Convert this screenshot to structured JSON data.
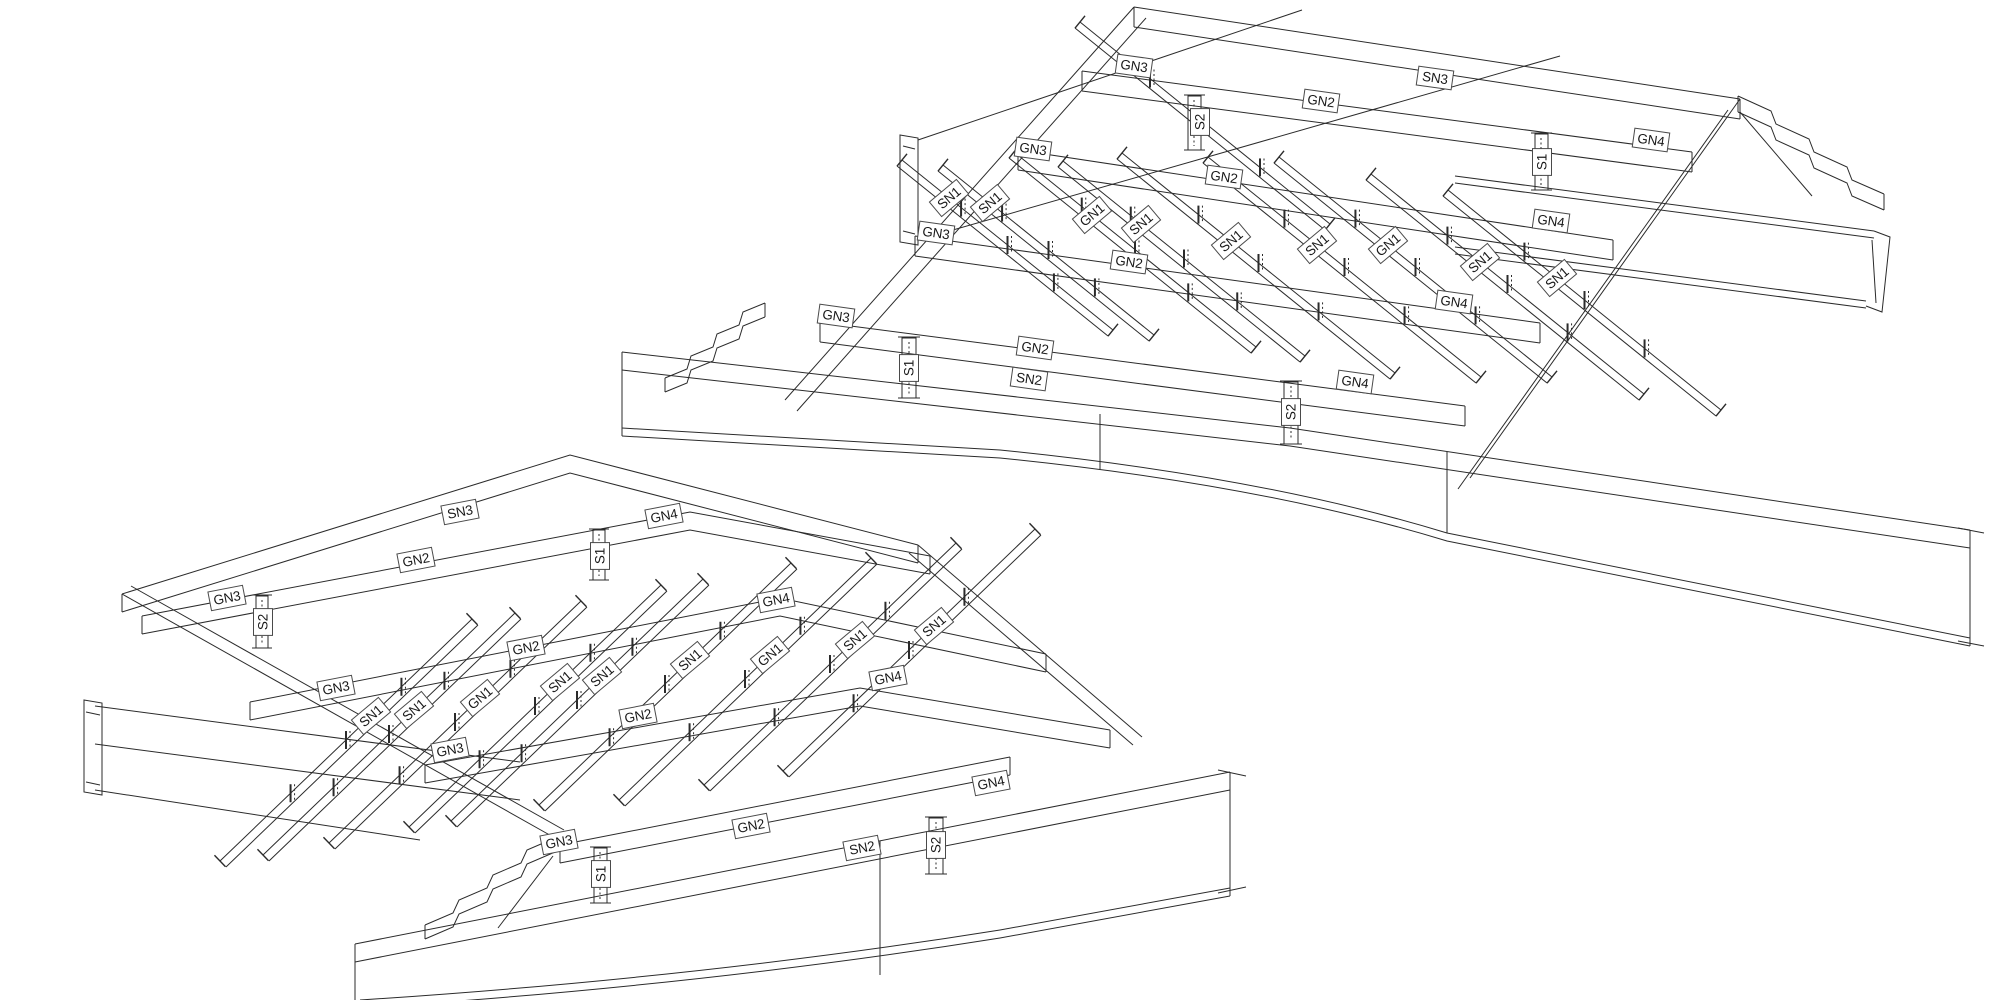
{
  "drawing": {
    "background_color": "#ffffff",
    "line_color": "#2b2b2b",
    "label_box_fill": "#ffffff",
    "label_box_border": "#4a4a4a",
    "label_text_color": "#1a1a1a",
    "structures": [
      {
        "id": "upper-grillage",
        "h_label_angle": 8,
        "diamond_label_angle": -40,
        "vertical_label_angle": -90,
        "labels": [
          {
            "text": "GN3",
            "x": 1134,
            "y": 66,
            "o": "h"
          },
          {
            "text": "GN2",
            "x": 1321,
            "y": 101,
            "o": "h"
          },
          {
            "text": "SN3",
            "x": 1435,
            "y": 78,
            "o": "h"
          },
          {
            "text": "GN4",
            "x": 1651,
            "y": 140,
            "o": "h"
          },
          {
            "text": "GN3",
            "x": 1033,
            "y": 149,
            "o": "h"
          },
          {
            "text": "GN2",
            "x": 1224,
            "y": 177,
            "o": "h"
          },
          {
            "text": "GN4",
            "x": 1551,
            "y": 221,
            "o": "h"
          },
          {
            "text": "GN3",
            "x": 936,
            "y": 233,
            "o": "h"
          },
          {
            "text": "GN2",
            "x": 1129,
            "y": 262,
            "o": "h"
          },
          {
            "text": "GN4",
            "x": 1454,
            "y": 302,
            "o": "h"
          },
          {
            "text": "GN3",
            "x": 836,
            "y": 316,
            "o": "h"
          },
          {
            "text": "GN2",
            "x": 1035,
            "y": 348,
            "o": "h"
          },
          {
            "text": "GN4",
            "x": 1355,
            "y": 382,
            "o": "h"
          },
          {
            "text": "SN2",
            "x": 1029,
            "y": 379,
            "o": "h"
          },
          {
            "text": "S2",
            "x": 1200,
            "y": 122,
            "o": "v"
          },
          {
            "text": "S1",
            "x": 1542,
            "y": 162,
            "o": "v"
          },
          {
            "text": "S1",
            "x": 909,
            "y": 368,
            "o": "v"
          },
          {
            "text": "S2",
            "x": 1291,
            "y": 412,
            "o": "v"
          },
          {
            "text": "SN1",
            "x": 949,
            "y": 198,
            "o": "d"
          },
          {
            "text": "SN1",
            "x": 990,
            "y": 203,
            "o": "d"
          },
          {
            "text": "GN1",
            "x": 1092,
            "y": 215,
            "o": "d"
          },
          {
            "text": "SN1",
            "x": 1141,
            "y": 224,
            "o": "d"
          },
          {
            "text": "SN1",
            "x": 1231,
            "y": 241,
            "o": "d"
          },
          {
            "text": "SN1",
            "x": 1317,
            "y": 245,
            "o": "d"
          },
          {
            "text": "GN1",
            "x": 1388,
            "y": 245,
            "o": "d"
          },
          {
            "text": "SN1",
            "x": 1480,
            "y": 262,
            "o": "d"
          },
          {
            "text": "SN1",
            "x": 1557,
            "y": 278,
            "o": "d"
          }
        ]
      },
      {
        "id": "lower-grillage",
        "h_label_angle": -11,
        "diamond_label_angle": -40,
        "vertical_label_angle": -90,
        "labels": [
          {
            "text": "SN3",
            "x": 460,
            "y": 512,
            "o": "h"
          },
          {
            "text": "GN4",
            "x": 664,
            "y": 516,
            "o": "h"
          },
          {
            "text": "GN2",
            "x": 416,
            "y": 560,
            "o": "h"
          },
          {
            "text": "GN3",
            "x": 227,
            "y": 598,
            "o": "h"
          },
          {
            "text": "GN4",
            "x": 776,
            "y": 600,
            "o": "h"
          },
          {
            "text": "GN2",
            "x": 526,
            "y": 648,
            "o": "h"
          },
          {
            "text": "GN3",
            "x": 336,
            "y": 688,
            "o": "h"
          },
          {
            "text": "GN4",
            "x": 888,
            "y": 678,
            "o": "h"
          },
          {
            "text": "GN2",
            "x": 638,
            "y": 716,
            "o": "h"
          },
          {
            "text": "GN3",
            "x": 450,
            "y": 750,
            "o": "h"
          },
          {
            "text": "GN4",
            "x": 991,
            "y": 783,
            "o": "h"
          },
          {
            "text": "GN2",
            "x": 751,
            "y": 826,
            "o": "h"
          },
          {
            "text": "GN3",
            "x": 559,
            "y": 842,
            "o": "h"
          },
          {
            "text": "SN2",
            "x": 862,
            "y": 848,
            "o": "h"
          },
          {
            "text": "S1",
            "x": 600,
            "y": 556,
            "o": "v"
          },
          {
            "text": "S2",
            "x": 263,
            "y": 622,
            "o": "v"
          },
          {
            "text": "S2",
            "x": 936,
            "y": 845,
            "o": "v"
          },
          {
            "text": "S1",
            "x": 601,
            "y": 874,
            "o": "v"
          },
          {
            "text": "SN1",
            "x": 371,
            "y": 716,
            "o": "d"
          },
          {
            "text": "SN1",
            "x": 414,
            "y": 710,
            "o": "d"
          },
          {
            "text": "GN1",
            "x": 480,
            "y": 698,
            "o": "d"
          },
          {
            "text": "SN1",
            "x": 560,
            "y": 682,
            "o": "d"
          },
          {
            "text": "SN1",
            "x": 602,
            "y": 676,
            "o": "d"
          },
          {
            "text": "SN1",
            "x": 690,
            "y": 660,
            "o": "d"
          },
          {
            "text": "GN1",
            "x": 770,
            "y": 655,
            "o": "d"
          },
          {
            "text": "SN1",
            "x": 855,
            "y": 640,
            "o": "d"
          },
          {
            "text": "SN1",
            "x": 934,
            "y": 626,
            "o": "d"
          }
        ]
      }
    ]
  }
}
